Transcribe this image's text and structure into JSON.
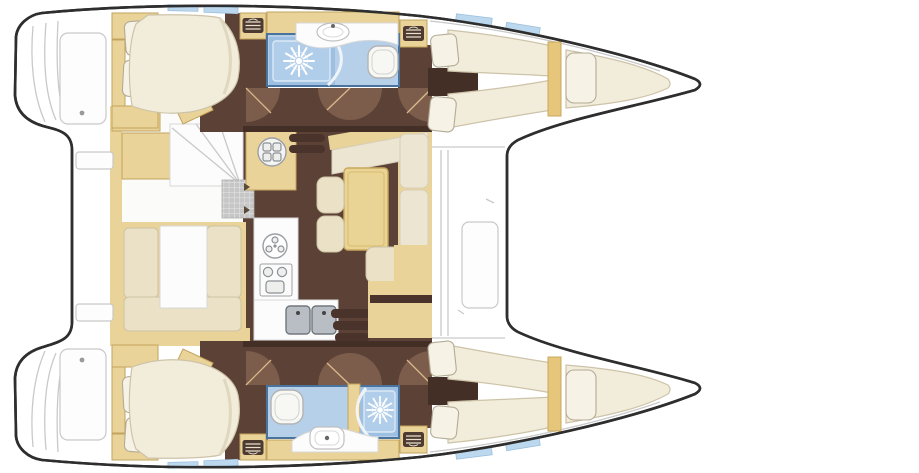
{
  "figure": {
    "type": "boat-floor-plan",
    "subject": "catamaran sailing yacht deck layout, top-down view",
    "orientation": {
      "bow": "right",
      "stern": "left"
    },
    "text_labels": []
  },
  "areas": {
    "port_hull": [
      "aft-double-cabin",
      "bathroom-with-shower-and-toilet",
      "forward-double-cabin",
      "forepeak-berth"
    ],
    "starboard_hull": [
      "aft-double-cabin",
      "bathroom-with-shower-and-toilet",
      "forward-double-cabin",
      "forepeak-berth"
    ],
    "bridgedeck": [
      "salon-dinette",
      "nav-cabinets",
      "galley-with-stove-and-sinks",
      "l-shaped-sofa",
      "dining-table",
      "companionway-steps-port",
      "companionway-steps-starboard"
    ],
    "exterior": [
      "aft-cockpit-faint",
      "transom-steps",
      "foredeck-locker",
      "trampoline-area"
    ]
  },
  "icons": [
    "shower-spray-icon",
    "toilet-icon",
    "washbasin-icon",
    "stove-burner-icon",
    "round-sink-icon",
    "double-sink-icon",
    "steps-hatch-icon",
    "door-swing-icon"
  ],
  "colors": {
    "outline": "#2e2e2e",
    "faint": "#c9c9c9",
    "tan": "#e9d398",
    "tan-border": "#c2a35c",
    "mattress": "#f2ecda",
    "mattress-border": "#cdc3a8",
    "cushion": "#eae1c6",
    "cushion-border": "#cdc3a6",
    "pillow": "#f6f2e6",
    "pillow-border": "#b2ab96",
    "floor-brown": "#5c4136",
    "wall-brown": "#442f27",
    "door-brown": "#7c5d4c",
    "door-line": "#d9b98a",
    "step-brown": "#4a332b",
    "bath-blue": "#b6d0ea",
    "bath-border": "#4a749e",
    "shower-blue": "#9dc0e2",
    "shower-inner": "#b0cdea",
    "window-blue": "#bcd8ee",
    "fixture-line": "#b3b3b3",
    "sink-gray": "#b8bec4",
    "white": "#ffffff"
  }
}
